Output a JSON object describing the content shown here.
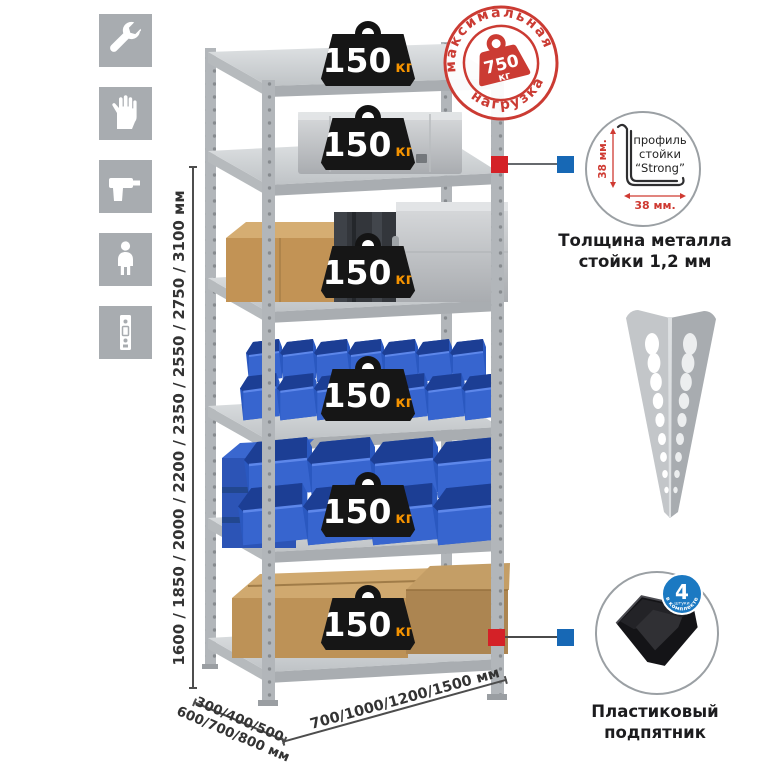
{
  "colors": {
    "marker_red": "#d42127",
    "marker_blue": "#1768b5",
    "stamp_red": "#cb3b33",
    "bin_blue": "#2a58c0",
    "kg_orange": "#f59300",
    "rack_gray": "#b2b6ba"
  },
  "sidebar": {
    "icons": [
      "wrench",
      "gloves",
      "drill",
      "person",
      "perforated-post"
    ]
  },
  "rack": {
    "shelf_count": 6,
    "shelf_load_value": "150",
    "shelf_load_unit": "кг"
  },
  "stamp": {
    "arc_top": "максимальная",
    "arc_bottom": "нагрузка",
    "value": "750",
    "unit": "кг"
  },
  "dimensions": {
    "height": "1600 / 1850 / 2000 / 2200 / 2350 / 2550 / 2750 / 3100 мм",
    "depth_line1": "300/400/500",
    "depth_line2": "600/700/800 мм",
    "width": "700/1000/1200/1500 мм"
  },
  "profile_detail": {
    "label_line1": "профиль",
    "label_line2": "стойки",
    "label_line3": "“Strong”",
    "dim_vertical": "38 мм.",
    "dim_horizontal": "38 мм.",
    "caption_line1": "Толщина металла",
    "caption_line2": "стойки 1,2 мм"
  },
  "foot_detail": {
    "badge_number": "4",
    "badge_sub": "штуки",
    "badge_arc": "в комплекте",
    "caption_line1": "Пластиковый",
    "caption_line2": "подпятник"
  }
}
